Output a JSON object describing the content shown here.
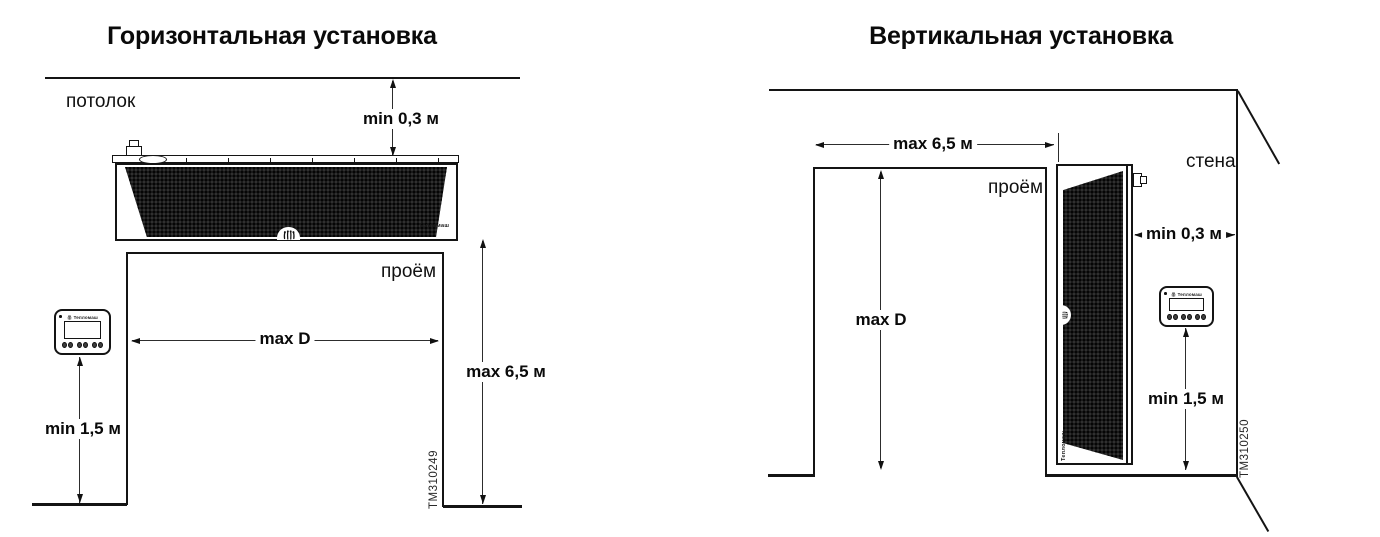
{
  "diagrams": {
    "horizontal": {
      "title": "Горизонтальная установка",
      "ceiling_label": "потолок",
      "opening_label": "проём",
      "dim_ceiling_clearance": "min 0,3 м",
      "dim_opening_width": "max D",
      "dim_opening_height": "max 6,5 м",
      "dim_controller_height": "min 1,5 м",
      "drawing_number": "TM310249",
      "unit_brand_label": "Тепломаш",
      "controller_brand_label": "Тепломаш"
    },
    "vertical": {
      "title": "Вертикальная установка",
      "wall_label": "стена",
      "opening_label": "проём",
      "dim_opening_width": "max 6,5 м",
      "dim_opening_height": "max D",
      "dim_wall_clearance": "min 0,3 м",
      "dim_controller_height": "min 1,5 м",
      "drawing_number": "TM310250",
      "unit_brand_label": "Тепломаш",
      "controller_brand_label": "Тепломаш"
    }
  },
  "colors": {
    "line": "#141414",
    "dimension_line": "#2d2d2d",
    "mesh_dark": "#191919",
    "background": "#ffffff"
  }
}
